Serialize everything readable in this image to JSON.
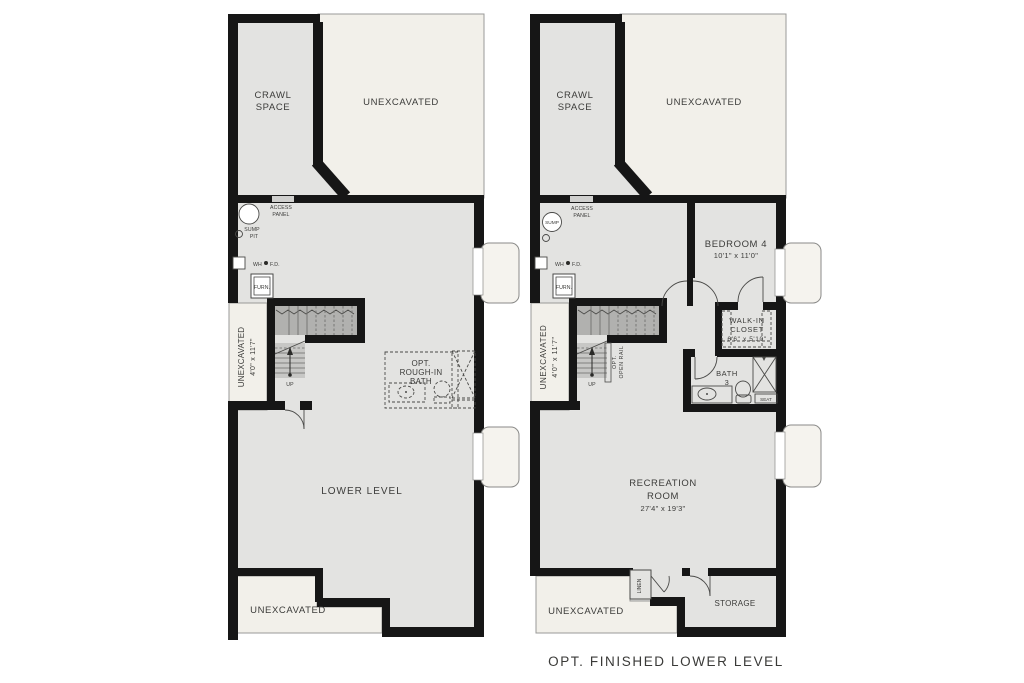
{
  "caption": "OPT. FINISHED LOWER LEVEL",
  "colors": {
    "wall": "#161616",
    "floor_gray": "#e3e3e1",
    "unexcavated_cream": "#f2f0ea",
    "stair_dark": "#b1b1af",
    "stair_light": "#c7c7c5",
    "text": "#3c3c3a"
  },
  "left_plan": {
    "crawl_space": [
      "CRAWL",
      "SPACE"
    ],
    "unexcavated_top": "UNEXCAVATED",
    "access_panel": [
      "ACCESS",
      "PANEL"
    ],
    "sump_pit": [
      "SUMP",
      "PIT"
    ],
    "wh": "WH",
    "fd": "F.D.",
    "furn": "FURN.",
    "unexcavated_strip": [
      "UNEXCAVATED",
      "4'0\" x 11'7\""
    ],
    "up": "UP",
    "rough_in_bath": [
      "OPT.",
      "ROUGH-IN",
      "BATH"
    ],
    "lower_level": "LOWER LEVEL",
    "unexcavated_bottom": "UNEXCAVATED"
  },
  "right_plan": {
    "crawl_space": [
      "CRAWL",
      "SPACE"
    ],
    "unexcavated_top": "UNEXCAVATED",
    "access_panel": [
      "ACCESS",
      "PANEL"
    ],
    "sump": "SUMP",
    "wh": "WH",
    "fd": "F.D.",
    "furn": "FURN.",
    "unexcavated_strip": [
      "UNEXCAVATED",
      "4'0\" x 11'7\""
    ],
    "up": "UP",
    "open_rail": [
      "OPT.",
      "OPEN RAIL"
    ],
    "bedroom4": {
      "name": "BEDROOM 4",
      "dims": "10'1\" x 11'0\""
    },
    "walk_in_closet": {
      "name": [
        "WALK-IN",
        "CLOSET"
      ],
      "dims": "6'6\" x 5'10\""
    },
    "bath3": [
      "BATH",
      "3"
    ],
    "seat": "SEAT",
    "recreation_room": {
      "name": [
        "RECREATION",
        "ROOM"
      ],
      "dims": "27'4\" x 19'3\""
    },
    "linen": "LINEN",
    "storage": "STORAGE",
    "unexcavated_bottom": "UNEXCAVATED"
  }
}
